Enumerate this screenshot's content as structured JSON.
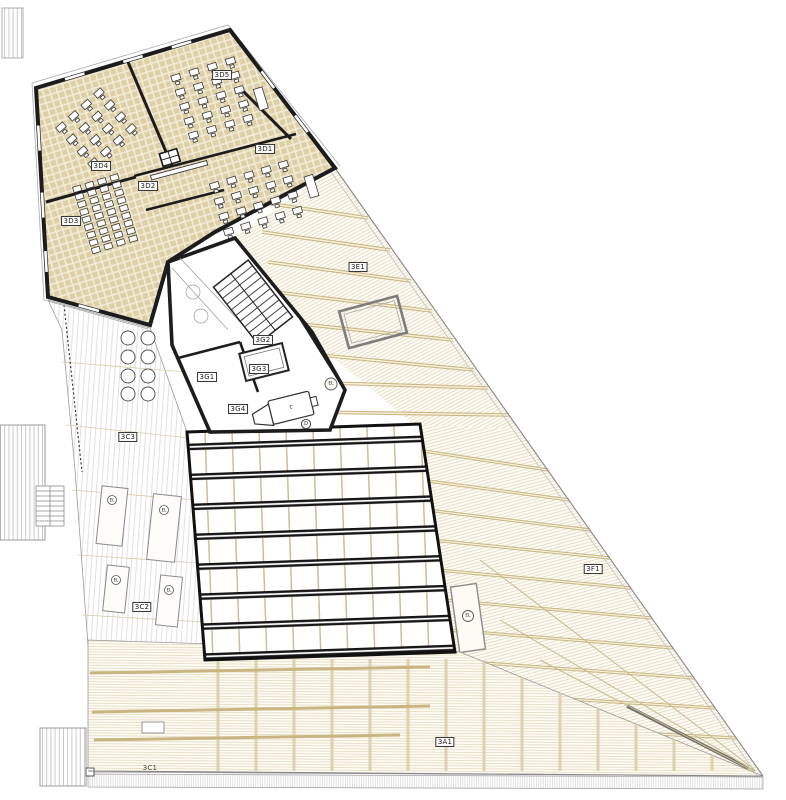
{
  "labels": {
    "d1": "3D1",
    "d2": "3D2",
    "d3": "3D3",
    "d4": "3D4",
    "d5": "3D5",
    "g1": "3G1",
    "g2": "3G2",
    "g3": "3G3",
    "g4": "3G4",
    "c1": "3C1",
    "c2": "3C2",
    "c3": "3C3",
    "e1": "3E1",
    "f1": "3F1",
    "a1": "3A1"
  },
  "markers": {
    "machine": "c",
    "door": "D",
    "drain": "EL"
  },
  "colors": {
    "paper": "#ffffff",
    "floor_beige": "#ddcfa6",
    "floor_joint": "#f2ecd9",
    "beam_tan": "#c9b581",
    "hatch_tan": "#dbcfae",
    "wall_black": "#1c1c1c",
    "line_gray": "#999999",
    "hatch_gray": "#c6c6c6"
  }
}
